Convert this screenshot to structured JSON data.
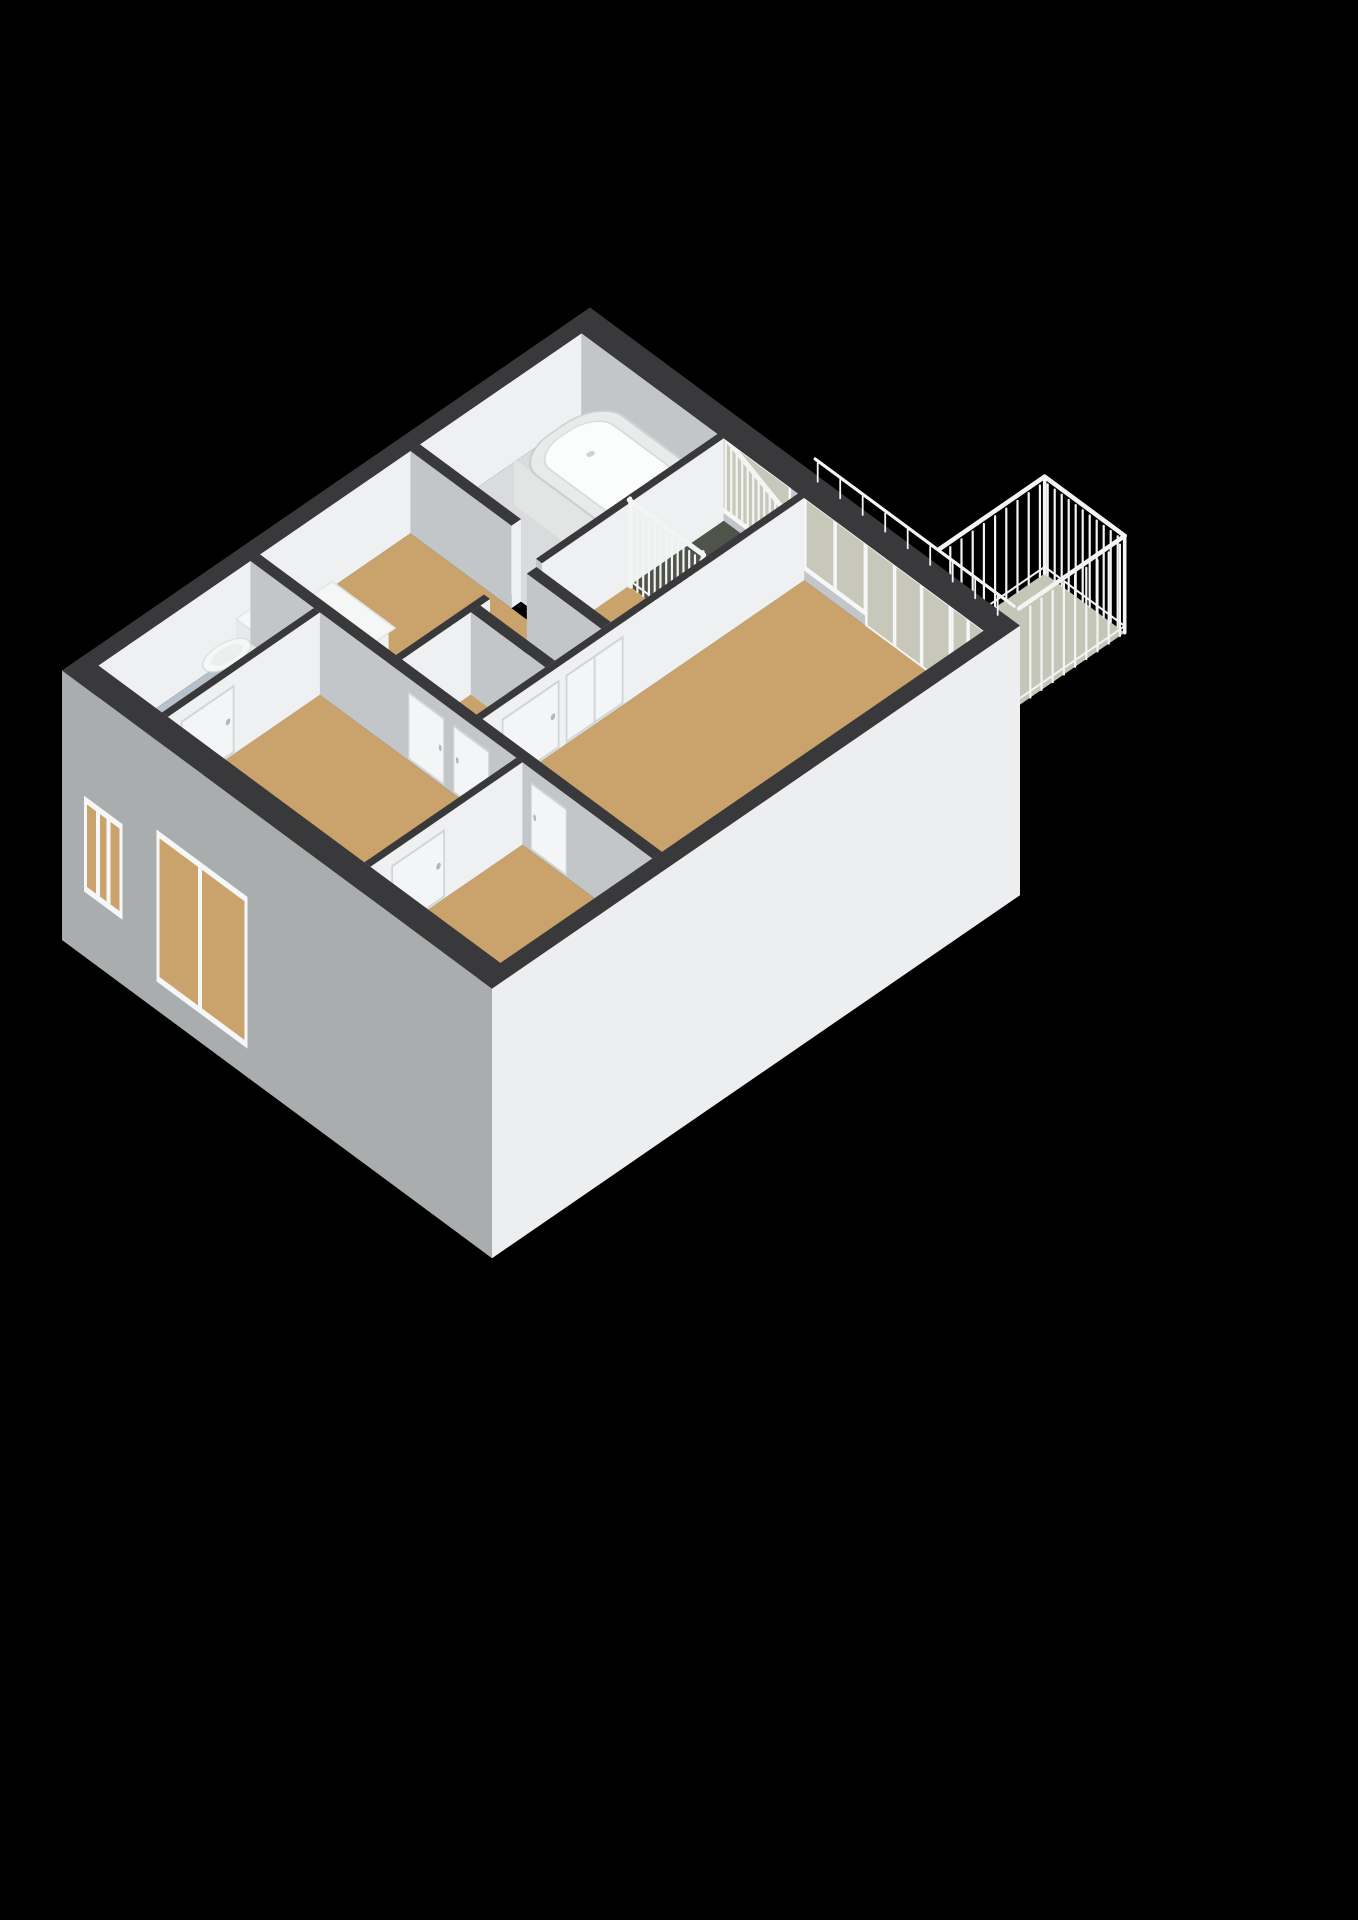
{
  "scene": {
    "projection": {
      "origin": [
        590,
        390
      ],
      "axis_x": [
        50,
        37
      ],
      "axis_y": [
        -80,
        55
      ],
      "unit_z": 110
    },
    "wall_height": 0.75,
    "ext_drop": -1.7,
    "palette": {
      "background": "#000000",
      "wall_top": "#39393b",
      "wall_face_light": "#eef0f1",
      "wall_face_shade": "#c2c6c8",
      "ext_face_sw": "#a9adae",
      "ext_face_se": "#eceef0",
      "floor_wood": "#c9a36b",
      "floor_bath": "#d9dbdc",
      "floor_wc": "#b7c1cb",
      "floor_stair": "#50534a",
      "floor_balcony": "#c5c6b8",
      "glass": "#c7c8ba",
      "railing": "#f3f4f4",
      "frame": "#f6f7f8",
      "tub_rim": "#e9ebeb",
      "tub_inner": "#fbfcfc",
      "fixture": "#f2f4f4",
      "panel_line": "#d2d5d6"
    },
    "building": {
      "width": 8.6,
      "depth": 6.6,
      "ext_thickness": 0.28
    },
    "rooms": [
      {
        "id": "bathroom",
        "rect": [
          0.28,
          0.28,
          3.0,
          2.3
        ],
        "floor": "floor_bath"
      },
      {
        "id": "stairwell",
        "rect": [
          3.12,
          0.28,
          4.61,
          1.46
        ],
        "floor": "floor_stair"
      },
      {
        "id": "hall",
        "rect": [
          3.12,
          1.46,
          4.61,
          4.3
        ],
        "floor": "floor_wood"
      },
      {
        "id": "study",
        "rect": [
          0.28,
          2.42,
          3.0,
          4.3
        ],
        "floor": "floor_wood"
      },
      {
        "id": "living-room",
        "rect": [
          4.73,
          0.28,
          8.32,
          4.3
        ],
        "floor": "floor_wood"
      },
      {
        "id": "wc",
        "rect": [
          0.28,
          4.42,
          1.55,
          6.32
        ],
        "floor": "floor_wc"
      },
      {
        "id": "bedroom",
        "rect": [
          1.67,
          4.42,
          5.6,
          6.32
        ],
        "floor": "floor_wood"
      },
      {
        "id": "room-2",
        "rect": [
          5.72,
          4.42,
          8.32,
          6.32
        ],
        "floor": "floor_wood"
      }
    ],
    "stair_steps": {
      "x0": 3.95,
      "w": 0.165,
      "count": 4,
      "y1": 0.28,
      "y2": 1.46,
      "colors": [
        "#90938a",
        "#7f8279",
        "#6e7168",
        "#5d6057"
      ]
    },
    "interior_walls": [
      {
        "id": "bath-study",
        "axis": "x",
        "band": [
          2.3,
          2.42
        ],
        "segments": [
          [
            0.28,
            2.3
          ]
        ]
      },
      {
        "id": "west-corridor",
        "axis": "y",
        "band": [
          3.0,
          3.12
        ],
        "segments": [
          [
            0.28,
            2.55
          ],
          [
            3.2,
            4.3
          ]
        ]
      },
      {
        "id": "closet-north",
        "axis": "x",
        "band": [
          2.62,
          2.74
        ],
        "segments": [
          [
            3.12,
            4.61
          ]
        ]
      },
      {
        "id": "closet-south",
        "axis": "x",
        "band": [
          3.32,
          3.44
        ],
        "segments": [
          [
            3.12,
            4.61
          ]
        ]
      },
      {
        "id": "east-corridor",
        "axis": "y",
        "band": [
          4.61,
          4.73
        ],
        "segments": [
          [
            0.28,
            4.3
          ]
        ],
        "panels": [
          {
            "range": [
              2.55,
              3.25
            ],
            "split": true
          },
          {
            "range": [
              3.35,
              4.05
            ],
            "handle": "start"
          }
        ]
      },
      {
        "id": "south-corridor",
        "axis": "x",
        "band": [
          4.3,
          4.42
        ],
        "segments": [
          [
            0.28,
            8.32
          ]
        ],
        "panels": [
          {
            "range": [
              3.45,
              4.15
            ],
            "handle": "end"
          },
          {
            "range": [
              4.35,
              5.05
            ],
            "handle": "start"
          },
          {
            "range": [
              5.9,
              6.6
            ],
            "handle": "start"
          }
        ]
      },
      {
        "id": "wc-bedroom",
        "axis": "y",
        "band": [
          1.55,
          1.67
        ],
        "segments": [
          [
            4.42,
            6.32
          ]
        ],
        "panels": [
          {
            "range": [
              5.5,
              6.15
            ],
            "handle": "start"
          }
        ]
      },
      {
        "id": "bedroom-room2",
        "axis": "y",
        "band": [
          5.6,
          5.72
        ],
        "segments": [
          [
            4.42,
            6.32
          ]
        ],
        "panels": [
          {
            "range": [
              5.4,
              6.05
            ],
            "handle": "start"
          }
        ]
      }
    ],
    "ne_windows": [
      {
        "id": "stair-window",
        "x": [
          3.08,
          4.42
        ],
        "sill": 0.12,
        "mullions": [],
        "balusters": {
          "step": 0.11,
          "w": 0.045,
          "z0": 0.1,
          "top_start": 0.8,
          "top_end": 0.5
        }
      },
      {
        "id": "living-window-1",
        "x": [
          4.78,
          5.92
        ],
        "sill": 0.14,
        "mullions": [
          5.35
        ]
      },
      {
        "id": "balcony-door",
        "x": [
          6.0,
          7.62
        ],
        "sill": 0.02,
        "mullions": [
          6.54,
          7.08
        ]
      },
      {
        "id": "living-window-2",
        "x": [
          7.72,
          8.3
        ],
        "sill": 0.14,
        "mullions": [
          8.01
        ]
      }
    ],
    "ne_top_rail": {
      "x": [
        4.6,
        8.58
      ],
      "y": 0.06,
      "z": [
        0.78,
        0.95
      ],
      "post_step": 0.45
    },
    "sw_windows": [
      {
        "id": "wc-window",
        "x": [
          0.5,
          1.15
        ],
        "z": [
          -1.05,
          -0.3
        ],
        "mullions": [
          0.72,
          0.93
        ]
      },
      {
        "id": "bedroom-window",
        "x": [
          1.95,
          3.65
        ],
        "z": [
          -1.38,
          -0.12
        ],
        "mullions": [
          2.76
        ]
      }
    ],
    "stair_railing": {
      "y": 1.46,
      "x": [
        3.12,
        4.61
      ],
      "post_step": 0.115,
      "rail_z": 0.78
    },
    "balcony": {
      "rect": [
        6.95,
        -1.34,
        8.55,
        -0.02
      ],
      "rail_z": 0.88,
      "post_step": 0.14
    },
    "furniture": {
      "bathtub": {
        "rect": [
          0.88,
          0.42,
          2.9,
          1.5
        ],
        "height": 0.42,
        "corner": 0.45,
        "inset": 0.14,
        "taps": [
          [
            2.56,
            0.7
          ],
          [
            2.56,
            1.14
          ]
        ],
        "spout": [
          2.68,
          0.92
        ],
        "drain": [
          1.55,
          0.96
        ]
      },
      "toilet": {
        "tank": [
          0.6,
          4.5,
          1.06,
          4.8
        ],
        "tank_h": 0.52,
        "bowl": [
          0.83,
          5.06,
          0.21,
          0.27
        ]
      },
      "cabinet": {
        "rect": [
          1.02,
          3.88,
          2.18,
          4.26
        ],
        "height": 0.46,
        "top_overhang": 0.05
      }
    }
  }
}
